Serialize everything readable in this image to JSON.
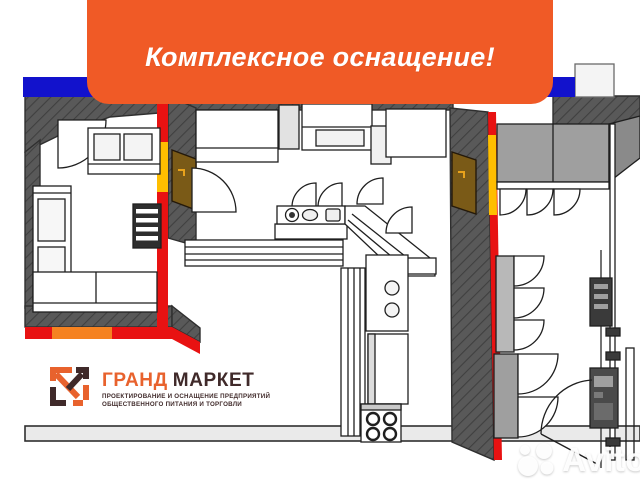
{
  "banner": {
    "label": "Комплексное оснащение!"
  },
  "logo": {
    "title_primary": "ГРАНД",
    "title_secondary": "МАРКЕТ",
    "tagline_line1": "ПРОЕКТИРОВАНИЕ И ОСНАЩЕНИЕ ПРЕДПРИЯТИЙ",
    "tagline_line2": "ОБЩЕСТВЕННОГО ПИТАНИЯ И ТОРГОВЛИ"
  },
  "watermark": {
    "label": "Avito"
  },
  "colors": {
    "banner_orange": "#F05A26",
    "accent_blue": "#1212CC",
    "wall_gray": "#595959",
    "accent_red": "#E81212",
    "accent_yellow": "#FFBE00",
    "accent_orange": "#F58220",
    "door_brown": "#7A5A17",
    "equipment_gray": "#9F9F9F",
    "floor_light": "#EAEAEA",
    "logo_orange": "#E8622D",
    "logo_dark": "#402A2A"
  }
}
